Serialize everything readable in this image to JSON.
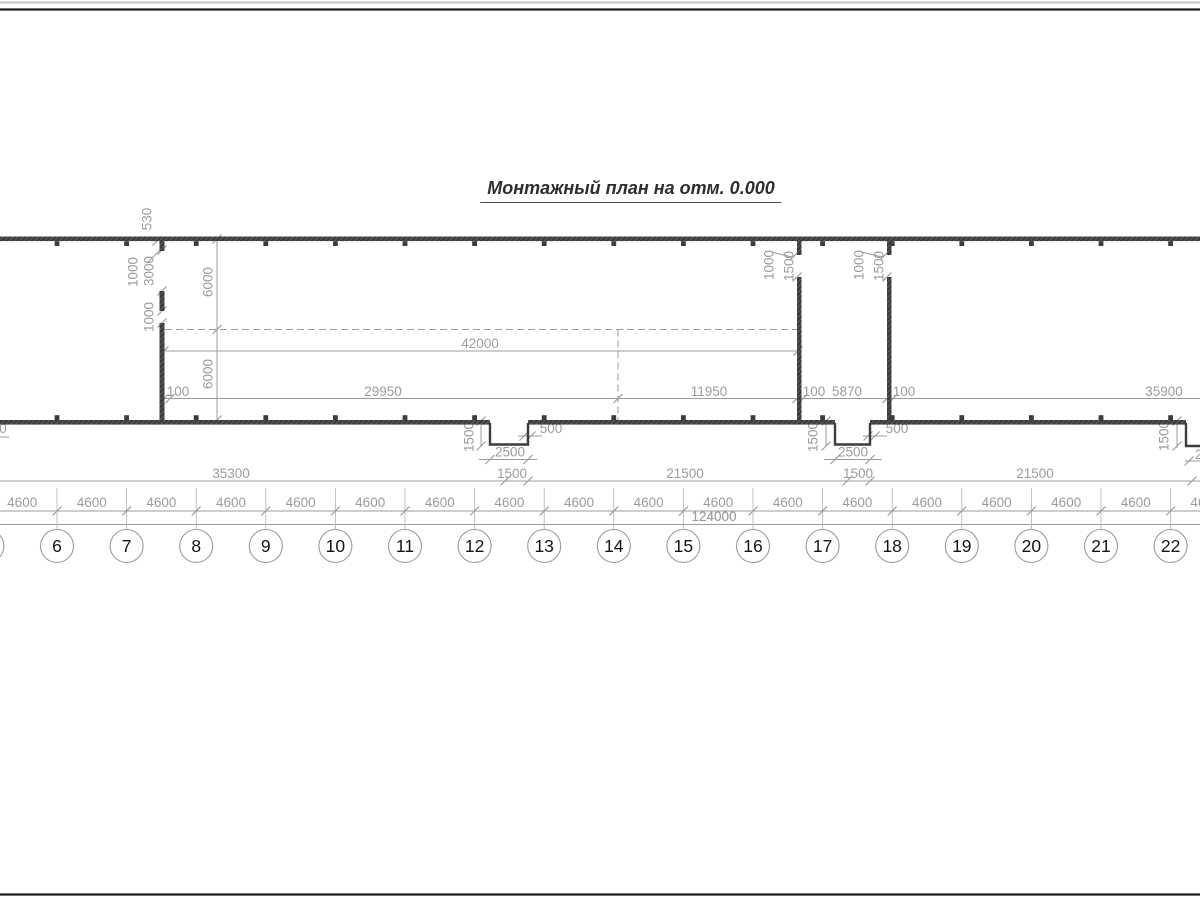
{
  "title": {
    "text": "Монтажный план на отм. 0.000"
  },
  "drawing": {
    "width": 1200,
    "height": 900,
    "colors": {
      "wall": "#3c3c3c",
      "dim": "#9c9c9c",
      "axis_line": "#b8b8b8",
      "circle": "#9b9b9b",
      "axis_text": "#141414",
      "frame_black": "#1c1c1c",
      "frame_gray": "#c2c2c2"
    },
    "frame_lines": [
      {
        "y": 2.5,
        "color": "#c2c2c2",
        "w": 2
      },
      {
        "y": 9.5,
        "color": "#1c1c1c",
        "w": 2.3
      },
      {
        "y": 894.5,
        "color": "#1c1c1c",
        "w": 2.3
      }
    ],
    "axis_grid": {
      "line_top": 488,
      "dim_line_y": 511,
      "total_line_y": 524.5,
      "circle_cy": 546,
      "radius": 16.5,
      "interval_label": "4600",
      "interval_label_y": 507,
      "total_label": "124000",
      "total_label_x": 714,
      "total_label_y": 521,
      "axes": [
        {
          "label": "5",
          "x": -12.6
        },
        {
          "label": "6",
          "x": 57
        },
        {
          "label": "7",
          "x": 126.6
        },
        {
          "label": "8",
          "x": 196.2
        },
        {
          "label": "9",
          "x": 265.8
        },
        {
          "label": "10",
          "x": 335.4
        },
        {
          "label": "11",
          "x": 405
        },
        {
          "label": "12",
          "x": 474.6
        },
        {
          "label": "13",
          "x": 544.2
        },
        {
          "label": "14",
          "x": 613.8
        },
        {
          "label": "15",
          "x": 683.4
        },
        {
          "label": "16",
          "x": 753
        },
        {
          "label": "17",
          "x": 822.6
        },
        {
          "label": "18",
          "x": 892.2
        },
        {
          "label": "19",
          "x": 961.8
        },
        {
          "label": "20",
          "x": 1031.4
        },
        {
          "label": "21",
          "x": 1101
        },
        {
          "label": "22",
          "x": 1170.6
        }
      ]
    },
    "col_marker": {
      "top_y": 241.2,
      "bottom_y": 415.2,
      "size": 4.8
    },
    "walls": [
      {
        "x": 0,
        "y": 236.5,
        "w": 1200,
        "h": 4.6
      },
      {
        "x": 0,
        "y": 420,
        "w": 490,
        "h": 4.6
      },
      {
        "x": 528,
        "y": 420,
        "w": 307,
        "h": 4.6
      },
      {
        "x": 870,
        "y": 420,
        "w": 316,
        "h": 4.6
      },
      {
        "x": 159.5,
        "y": 241,
        "w": 5,
        "h": 10
      },
      {
        "x": 159.5,
        "y": 291,
        "w": 5,
        "h": 20
      },
      {
        "x": 159.5,
        "y": 323,
        "w": 5,
        "h": 101.5
      },
      {
        "x": 797,
        "y": 241,
        "w": 4.5,
        "h": 14
      },
      {
        "x": 797,
        "y": 277,
        "w": 4.5,
        "h": 147.5
      },
      {
        "x": 887,
        "y": 241,
        "w": 4.5,
        "h": 14
      },
      {
        "x": 887,
        "y": 277,
        "w": 4.5,
        "h": 147.5
      }
    ],
    "notches": [
      "M490,423 L490,444.5 L528,444.5 L528,423",
      "M835,423 L835,444.5 L870,444.5 L870,423",
      "M1186,423 L1186,446 L1201,446"
    ],
    "lines": [
      {
        "x1": 165,
        "y1": 329.5,
        "x2": 798,
        "y2": 329.5,
        "dash": "7,4"
      },
      {
        "x1": 618,
        "y1": 329.5,
        "x2": 618,
        "y2": 420,
        "dash": "7,4"
      },
      {
        "x1": 164,
        "y1": 351,
        "x2": 798,
        "y2": 351
      },
      {
        "x1": 164,
        "y1": 398.5,
        "x2": 1200,
        "y2": 398.5
      },
      {
        "x1": 0,
        "y1": 481,
        "x2": 1200,
        "y2": 481
      },
      {
        "x1": 479,
        "y1": 459.5,
        "x2": 537,
        "y2": 459.5
      },
      {
        "x1": 824,
        "y1": 459.5,
        "x2": 882,
        "y2": 459.5
      },
      {
        "x1": 0,
        "y1": 511,
        "x2": 1200,
        "y2": 511
      },
      {
        "x1": 0,
        "y1": 524.5,
        "x2": 1200,
        "y2": 524.5
      },
      {
        "x1": 217,
        "y1": 239,
        "x2": 217,
        "y2": 420
      },
      {
        "x1": 481,
        "y1": 421,
        "x2": 481,
        "y2": 447
      },
      {
        "x1": 826,
        "y1": 421,
        "x2": 826,
        "y2": 447
      },
      {
        "x1": 1177,
        "y1": 421,
        "x2": 1177,
        "y2": 448
      },
      {
        "x1": 147,
        "y1": 263,
        "x2": 161,
        "y2": 249
      },
      {
        "x1": 771,
        "y1": 252,
        "x2": 792,
        "y2": 257
      },
      {
        "x1": 861,
        "y1": 252,
        "x2": 882,
        "y2": 257
      },
      {
        "x1": 518,
        "y1": 436,
        "x2": 542,
        "y2": 436
      },
      {
        "x1": 863,
        "y1": 436,
        "x2": 887,
        "y2": 436
      },
      {
        "x1": 1185,
        "y1": 461,
        "x2": 1200,
        "y2": 461
      },
      {
        "x1": 0,
        "y1": 437,
        "x2": 9,
        "y2": 437
      }
    ],
    "ticks": [
      [
        164,
        351
      ],
      [
        798,
        351
      ],
      [
        164,
        398.5
      ],
      [
        170,
        398.5
      ],
      [
        618,
        398.5
      ],
      [
        797,
        398.5
      ],
      [
        803,
        398.5
      ],
      [
        887,
        398.5
      ],
      [
        893,
        398.5
      ],
      [
        505,
        481
      ],
      [
        528,
        481
      ],
      [
        847,
        481
      ],
      [
        870,
        481
      ],
      [
        1192,
        481
      ],
      [
        490,
        459.5
      ],
      [
        528,
        459.5
      ],
      [
        835,
        459.5
      ],
      [
        870,
        459.5
      ],
      [
        524,
        436
      ],
      [
        531,
        436
      ],
      [
        868,
        436
      ],
      [
        875,
        436
      ],
      [
        217,
        239
      ],
      [
        217,
        329.5
      ],
      [
        217,
        420
      ],
      [
        157,
        241
      ],
      [
        162,
        250
      ],
      [
        162,
        291
      ],
      [
        162,
        311
      ],
      [
        162,
        323
      ],
      [
        795,
        255
      ],
      [
        797,
        277
      ],
      [
        885,
        255
      ],
      [
        887,
        277
      ],
      [
        481,
        421
      ],
      [
        481,
        446
      ],
      [
        826,
        421
      ],
      [
        826,
        446
      ],
      [
        1177,
        421
      ],
      [
        1177,
        446
      ],
      [
        1189,
        461
      ]
    ],
    "labels": [
      {
        "t": "42000",
        "x": 480,
        "y": 348
      },
      {
        "t": "100",
        "x": 178,
        "y": 396
      },
      {
        "t": "29950",
        "x": 383,
        "y": 396
      },
      {
        "t": "11950",
        "x": 709,
        "y": 396
      },
      {
        "t": "100",
        "x": 814,
        "y": 396
      },
      {
        "t": "5870",
        "x": 847,
        "y": 396
      },
      {
        "t": "100",
        "x": 904,
        "y": 396
      },
      {
        "t": "35900",
        "x": 1164,
        "y": 396
      },
      {
        "t": "35300",
        "x": 231,
        "y": 478
      },
      {
        "t": "1500",
        "x": 512,
        "y": 478
      },
      {
        "t": "21500",
        "x": 685,
        "y": 478
      },
      {
        "t": "1500",
        "x": 858,
        "y": 478
      },
      {
        "t": "21500",
        "x": 1035,
        "y": 478
      },
      {
        "t": "2500",
        "x": 510,
        "y": 456.5
      },
      {
        "t": "2500",
        "x": 853,
        "y": 456.5
      },
      {
        "t": "500",
        "x": 551,
        "y": 433
      },
      {
        "t": "500",
        "x": 897,
        "y": 433
      },
      {
        "t": "2500",
        "x": 1210,
        "y": 459
      },
      {
        "t": "0",
        "x": 3,
        "y": 433
      },
      {
        "t": "124000",
        "x": 714,
        "y": 521
      }
    ],
    "rotated_labels": [
      {
        "t": "530",
        "x": 147,
        "y": 219
      },
      {
        "t": "1000",
        "x": 133,
        "y": 272
      },
      {
        "t": "3000",
        "x": 149,
        "y": 271
      },
      {
        "t": "1000",
        "x": 149,
        "y": 317
      },
      {
        "t": "6000",
        "x": 208,
        "y": 282
      },
      {
        "t": "6000",
        "x": 208,
        "y": 374
      },
      {
        "t": "1000",
        "x": 769,
        "y": 265
      },
      {
        "t": "1500",
        "x": 789,
        "y": 266
      },
      {
        "t": "1000",
        "x": 859,
        "y": 265
      },
      {
        "t": "1500",
        "x": 879,
        "y": 266
      },
      {
        "t": "1500",
        "x": 469,
        "y": 437
      },
      {
        "t": "1500",
        "x": 813,
        "y": 437
      },
      {
        "t": "1500",
        "x": 1164,
        "y": 436
      }
    ]
  }
}
